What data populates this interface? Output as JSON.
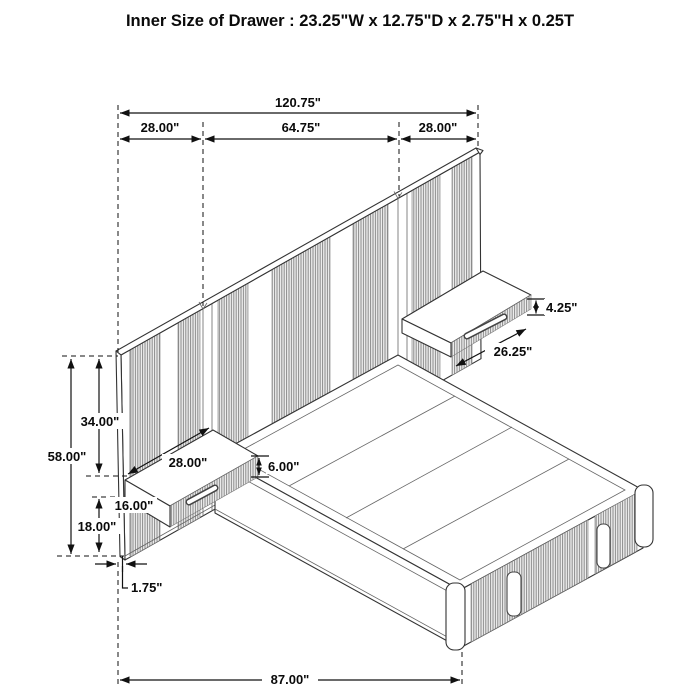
{
  "title": "Inner Size of Drawer : 23.25\"W x 12.75\"D x 2.75\"H x 0.25T",
  "dimensions": {
    "overall_width": "120.75\"",
    "left_panel_width": "28.00\"",
    "center_panel_width": "64.75\"",
    "right_panel_width": "28.00\"",
    "headboard_height": "58.00\"",
    "top_to_nightstand": "34.00\"",
    "bed_platform_height": "16.00\"",
    "nightstand_floor_clearance": "18.00\"",
    "panel_thickness": "1.75\"",
    "bed_length": "87.00\"",
    "right_nightstand_height": "4.25\"",
    "right_nightstand_width": "26.25\"",
    "left_nightstand_width": "28.00\"",
    "left_nightstand_height": "6.00\""
  }
}
